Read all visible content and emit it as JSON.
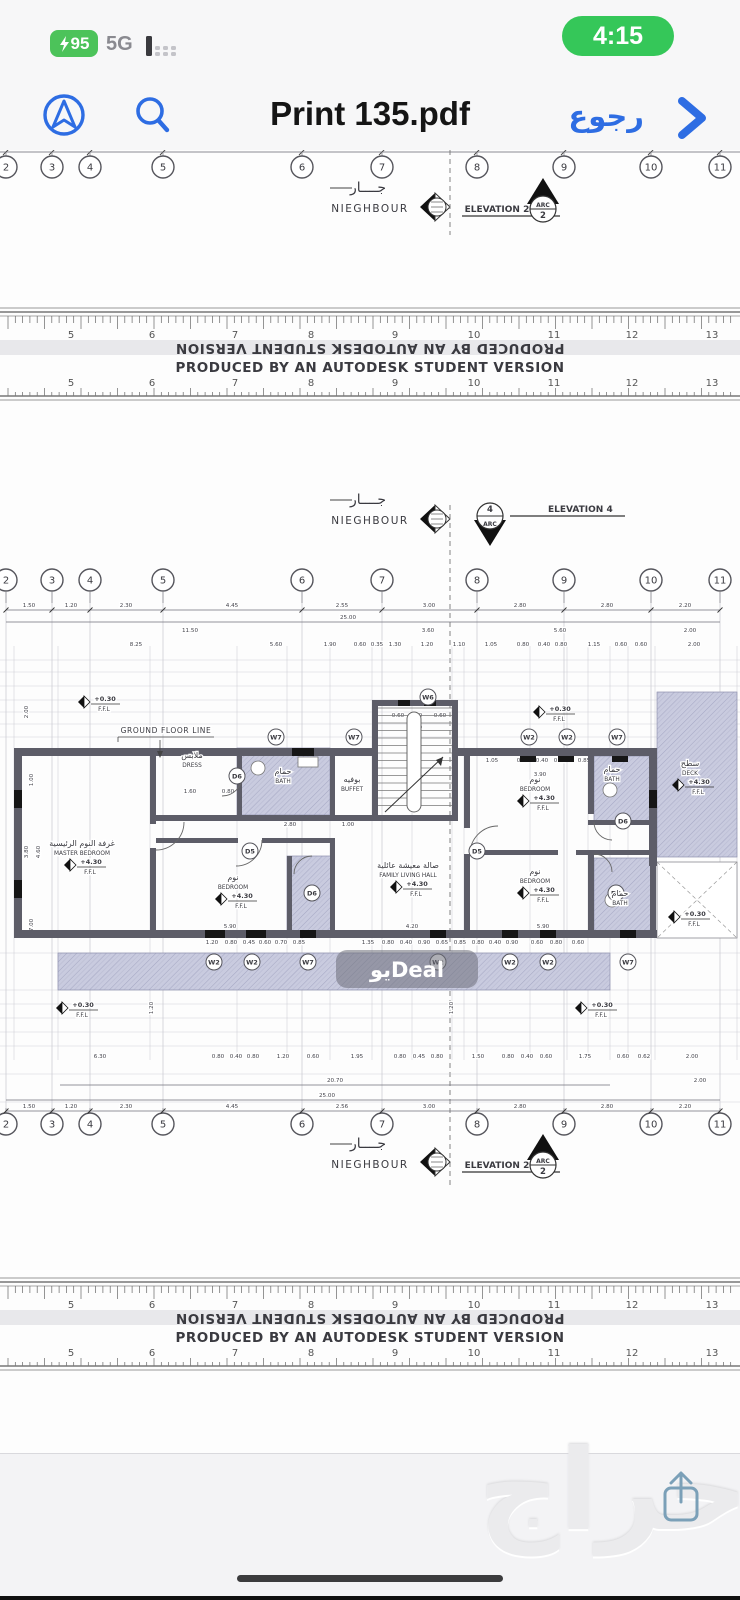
{
  "status_bar": {
    "battery_percent": "95",
    "network": "5G",
    "time": "4:15"
  },
  "toolbar": {
    "title": "Print 135.pdf",
    "back_label": "رجوع"
  },
  "icons": {
    "nav": "navigation-arrow-icon",
    "search": "search-icon",
    "back_chevron": "chevron-right-icon",
    "battery_bolt": "lightning-bolt-icon",
    "signal": "signal-bars-icon",
    "share": "share-icon",
    "home": "home-indicator"
  },
  "colors": {
    "accent_blue": "#2e6de3",
    "pill_green": "#4cc35a",
    "time_green": "#35c759",
    "hatch_fill": "#c9cbdf",
    "hatch_line": "#a6a8c4",
    "wall_gray": "#5d5d68",
    "line_gray": "#8a8a92"
  },
  "pdf": {
    "autodesk_banner": "PRODUCED BY AN AUTODESK STUDENT VERSION",
    "ruler_numbers": [
      "5",
      "6",
      "7",
      "8",
      "9",
      "10",
      "11",
      "12",
      "13"
    ],
    "ruler_number_x": [
      71,
      152,
      235,
      311,
      395,
      474,
      554,
      632,
      712
    ],
    "grid_labels": [
      "2",
      "3",
      "4",
      "5",
      "6",
      "7",
      "8",
      "9",
      "10",
      "11"
    ],
    "grid_x": [
      6,
      52,
      90,
      163,
      302,
      382,
      477,
      564,
      651,
      720
    ],
    "bubble_rows_cy": [
      167,
      580,
      1124
    ],
    "neighbour": {
      "ar": "جــــار",
      "en": "NIEGHBOUR"
    },
    "neighbour_y": [
      192,
      504,
      1148
    ],
    "elevation_markers": [
      {
        "label": "ELEVATION 2",
        "tag_line1": "ARC",
        "tag_line2": "2",
        "y": 206,
        "variant": "arc2"
      },
      {
        "label": "ELEVATION 4",
        "tag_line1": "4",
        "tag_line2": "ARC",
        "y": 518,
        "variant": "arc4"
      },
      {
        "label": "ELEVATION 2",
        "tag_line1": "ARC",
        "tag_line2": "2",
        "y": 1162,
        "variant": "arc2"
      }
    ],
    "ground_floor_line": "GROUND FLOOR LINE",
    "ffl": "F.F.L",
    "rooms": [
      {
        "ar": "غرفة النوم الرئيسية",
        "en": "MASTER BEDROOM",
        "x": 82,
        "y": 846,
        "level": "+4.30"
      },
      {
        "ar": "ملابس",
        "en": "DRESS",
        "x": 192,
        "y": 758
      },
      {
        "ar": "حمام",
        "en": "BATH",
        "x": 283,
        "y": 774
      },
      {
        "ar": "بوفيه",
        "en": "BUFFET",
        "x": 352,
        "y": 782
      },
      {
        "ar": "نوم",
        "en": "BEDROOM",
        "x": 233,
        "y": 880,
        "level": "+4.30"
      },
      {
        "ar": "صالة معيشة عائلية",
        "en": "FAMILY LIVING HALL",
        "x": 408,
        "y": 868,
        "level": "+4.30"
      },
      {
        "ar": "نوم",
        "en": "BEDROOM",
        "x": 535,
        "y": 782,
        "level": "+4.30"
      },
      {
        "ar": "حمام",
        "en": "BATH",
        "x": 612,
        "y": 772
      },
      {
        "ar": "نوم",
        "en": "BEDROOM",
        "x": 535,
        "y": 874,
        "level": "+4.30"
      },
      {
        "ar": "حمام",
        "en": "BATH",
        "x": 620,
        "y": 896
      },
      {
        "ar": "سطح",
        "en": "DECK",
        "x": 690,
        "y": 766,
        "level": "+4.30"
      }
    ],
    "flags": [
      {
        "x": 88,
        "y": 702,
        "level": "+0.30"
      },
      {
        "x": 543,
        "y": 712,
        "level": "+0.30"
      },
      {
        "x": 678,
        "y": 917,
        "level": "+0.30"
      },
      {
        "x": 66,
        "y": 1008,
        "level": "+0.30"
      },
      {
        "x": 585,
        "y": 1008,
        "level": "+0.30"
      }
    ],
    "window_tags": [
      {
        "t": "W6",
        "x": 428,
        "y": 697
      },
      {
        "t": "W7",
        "x": 276,
        "y": 737
      },
      {
        "t": "W7",
        "x": 354,
        "y": 737
      },
      {
        "t": "W2",
        "x": 529,
        "y": 737
      },
      {
        "t": "W2",
        "x": 567,
        "y": 737
      },
      {
        "t": "W7",
        "x": 617,
        "y": 737
      },
      {
        "t": "W2",
        "x": 214,
        "y": 962
      },
      {
        "t": "W2",
        "x": 252,
        "y": 962
      },
      {
        "t": "W7",
        "x": 308,
        "y": 962
      },
      {
        "t": "W2",
        "x": 438,
        "y": 962
      },
      {
        "t": "W2",
        "x": 510,
        "y": 962
      },
      {
        "t": "W2",
        "x": 548,
        "y": 962
      },
      {
        "t": "W7",
        "x": 628,
        "y": 962
      }
    ],
    "door_tags": [
      {
        "t": "D6",
        "x": 237,
        "y": 776
      },
      {
        "t": "D5",
        "x": 250,
        "y": 851
      },
      {
        "t": "D5",
        "x": 477,
        "y": 851
      },
      {
        "t": "D6",
        "x": 312,
        "y": 893
      },
      {
        "t": "D6",
        "x": 623,
        "y": 821
      },
      {
        "t": "D6",
        "x": 616,
        "y": 893
      }
    ],
    "dim_rows": [
      {
        "y": 607,
        "ticks": true,
        "line": [
          6,
          720
        ],
        "items": [
          [
            29,
            "1.50"
          ],
          [
            71,
            "1.20"
          ],
          [
            126,
            "2.30"
          ],
          [
            232,
            "4.45"
          ],
          [
            342,
            "2.55"
          ],
          [
            429,
            "3.00"
          ],
          [
            520,
            "2.80"
          ],
          [
            607,
            "2.80"
          ],
          [
            685,
            "2.20"
          ]
        ]
      },
      {
        "y": 619,
        "line": [
          6,
          720
        ],
        "items": [
          [
            348,
            "25.00"
          ]
        ]
      },
      {
        "y": 632,
        "items": [
          [
            190,
            "11.50"
          ],
          [
            428,
            "3.60"
          ],
          [
            560,
            "5.60"
          ],
          [
            690,
            "2.00"
          ]
        ]
      },
      {
        "y": 646,
        "items": [
          [
            136,
            "8.25"
          ],
          [
            276,
            "5.60"
          ],
          [
            330,
            "1.90"
          ],
          [
            360,
            "0.60"
          ],
          [
            377,
            "0.35"
          ],
          [
            395,
            "1.30"
          ],
          [
            427,
            "1.20"
          ],
          [
            459,
            "1.10"
          ],
          [
            491,
            "1.05"
          ],
          [
            523,
            "0.80"
          ],
          [
            544,
            "0.40"
          ],
          [
            561,
            "0.80"
          ],
          [
            594,
            "1.15"
          ],
          [
            621,
            "0.60"
          ],
          [
            641,
            "0.60"
          ],
          [
            694,
            "2.00"
          ]
        ]
      },
      {
        "y": 717,
        "items": [
          [
            398,
            "0.60"
          ],
          [
            416,
            "1.30"
          ],
          [
            440,
            "0.60"
          ]
        ]
      },
      {
        "y": 729,
        "items": [
          [
            416,
            "1.00"
          ]
        ]
      },
      {
        "y": 762,
        "items": [
          [
            492,
            "1.05"
          ],
          [
            523,
            "0.80"
          ],
          [
            542,
            "0.40"
          ],
          [
            560,
            "0.85"
          ],
          [
            584,
            "0.85"
          ],
          [
            610,
            "0.60"
          ],
          [
            628,
            "0.40"
          ],
          [
            645,
            "0.65"
          ]
        ]
      },
      {
        "y": 768,
        "items": [
          [
            283,
            "2.60"
          ]
        ]
      },
      {
        "y": 776,
        "items": [
          [
            540,
            "3.90"
          ]
        ]
      },
      {
        "y": 793,
        "items": [
          [
            190,
            "1.60"
          ],
          [
            228,
            "0.80"
          ]
        ]
      },
      {
        "y": 826,
        "items": [
          [
            290,
            "2.80"
          ],
          [
            348,
            "1.00"
          ]
        ]
      },
      {
        "y": 870,
        "items": [
          [
            628,
            "1.40"
          ]
        ]
      },
      {
        "y": 912,
        "items": [
          [
            618,
            "1.40"
          ]
        ]
      },
      {
        "y": 928,
        "items": [
          [
            230,
            "5.90"
          ],
          [
            412,
            "4.20"
          ],
          [
            543,
            "5.90"
          ],
          [
            700,
            "9.00"
          ]
        ]
      },
      {
        "y": 944,
        "items": [
          [
            212,
            "1.20"
          ],
          [
            231,
            "0.80"
          ],
          [
            249,
            "0.45"
          ],
          [
            265,
            "0.60"
          ],
          [
            281,
            "0.70"
          ],
          [
            299,
            "0.85"
          ],
          [
            368,
            "1.35"
          ],
          [
            388,
            "0.80"
          ],
          [
            406,
            "0.40"
          ],
          [
            424,
            "0.90"
          ],
          [
            442,
            "0.65"
          ],
          [
            460,
            "0.85"
          ],
          [
            478,
            "0.80"
          ],
          [
            495,
            "0.40"
          ],
          [
            512,
            "0.90"
          ],
          [
            537,
            "0.60"
          ],
          [
            556,
            "0.80"
          ],
          [
            578,
            "0.60"
          ]
        ]
      },
      {
        "y": 1058,
        "items": [
          [
            100,
            "6.30"
          ],
          [
            218,
            "0.80"
          ],
          [
            236,
            "0.40"
          ],
          [
            253,
            "0.80"
          ],
          [
            283,
            "1.20"
          ],
          [
            313,
            "0.60"
          ],
          [
            357,
            "1.95"
          ],
          [
            400,
            "0.80"
          ],
          [
            419,
            "0.45"
          ],
          [
            437,
            "0.80"
          ],
          [
            478,
            "1.50"
          ],
          [
            508,
            "0.80"
          ],
          [
            527,
            "0.40"
          ],
          [
            546,
            "0.60"
          ],
          [
            585,
            "1.75"
          ],
          [
            623,
            "0.60"
          ],
          [
            644,
            "0.62"
          ],
          [
            692,
            "2.00"
          ]
        ]
      },
      {
        "y": 1082,
        "line": [
          60,
          610
        ],
        "items": [
          [
            335,
            "20.70"
          ],
          [
            700,
            "2.00"
          ]
        ]
      },
      {
        "y": 1097,
        "line": [
          6,
          720
        ],
        "items": [
          [
            327,
            "25.00"
          ]
        ]
      },
      {
        "y": 1108,
        "ticks": true,
        "line": [
          6,
          720
        ],
        "items": [
          [
            29,
            "1.50"
          ],
          [
            71,
            "1.20"
          ],
          [
            126,
            "2.30"
          ],
          [
            232,
            "4.45"
          ],
          [
            342,
            "2.56"
          ],
          [
            429,
            "3.00"
          ],
          [
            520,
            "2.80"
          ],
          [
            607,
            "2.80"
          ],
          [
            685,
            "2.20"
          ]
        ]
      }
    ],
    "vdims": [
      [
        28,
        712,
        "2.00"
      ],
      [
        33,
        780,
        "1.00"
      ],
      [
        28,
        852,
        "3.80"
      ],
      [
        40,
        852,
        "4.60"
      ],
      [
        33,
        925,
        "7.00"
      ],
      [
        697,
        790,
        "7.20"
      ],
      [
        712,
        700,
        "2.00"
      ],
      [
        153,
        1008,
        "1.20"
      ],
      [
        453,
        1008,
        "1.20"
      ]
    ]
  },
  "watermarks": {
    "chip": "يوDeal",
    "big": "حراج"
  }
}
